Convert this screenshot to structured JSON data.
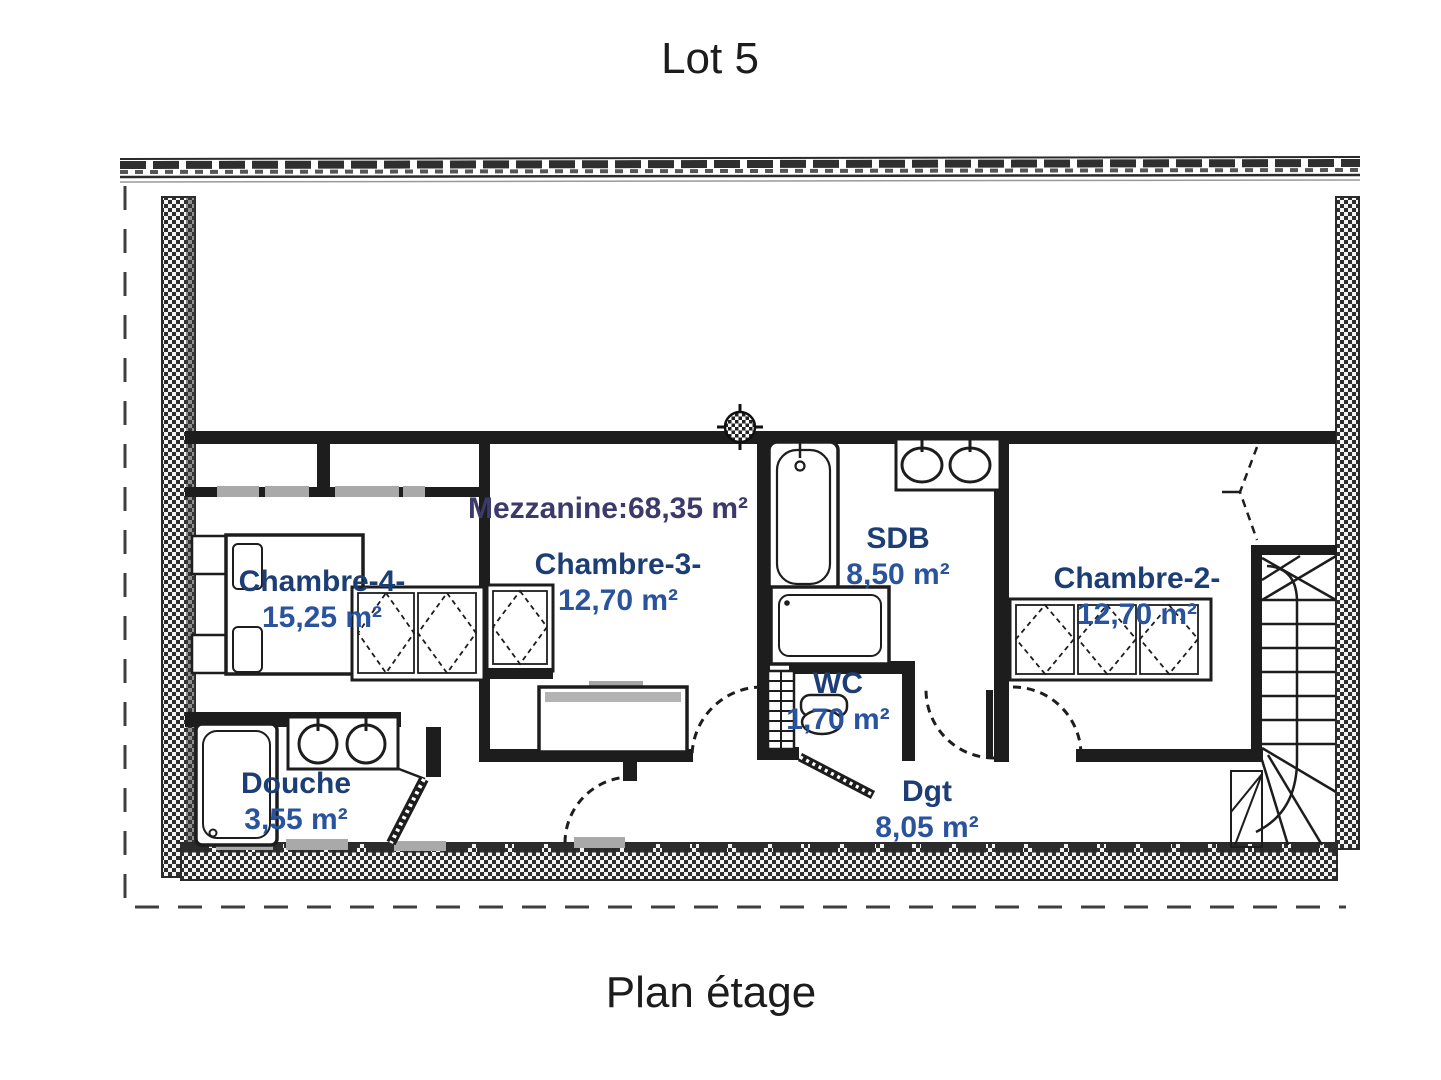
{
  "title": "Lot 5",
  "caption": "Plan étage",
  "mezzanine": {
    "label": "Mezzanine:68,35 m²"
  },
  "rooms": [
    {
      "name": "Chambre-4-",
      "area": "15,25 m²"
    },
    {
      "name": "Chambre-3-",
      "area": "12,70 m²"
    },
    {
      "name": "SDB",
      "area": "8,50 m²"
    },
    {
      "name": "WC",
      "area": "1,70 m²"
    },
    {
      "name": "Chambre-2-",
      "area": "12,70 m²"
    },
    {
      "name": "Douche",
      "area": "3,55 m²"
    },
    {
      "name": "Dgt",
      "area": "8,05 m²"
    }
  ],
  "colors": {
    "room_name": "#1c3e74",
    "room_area": "#2a539e",
    "mezzanine_label": "#3c3a6b",
    "wall": "#1d1d1d",
    "window": "#a9a9a9",
    "title_text": "#1c1c1c"
  }
}
